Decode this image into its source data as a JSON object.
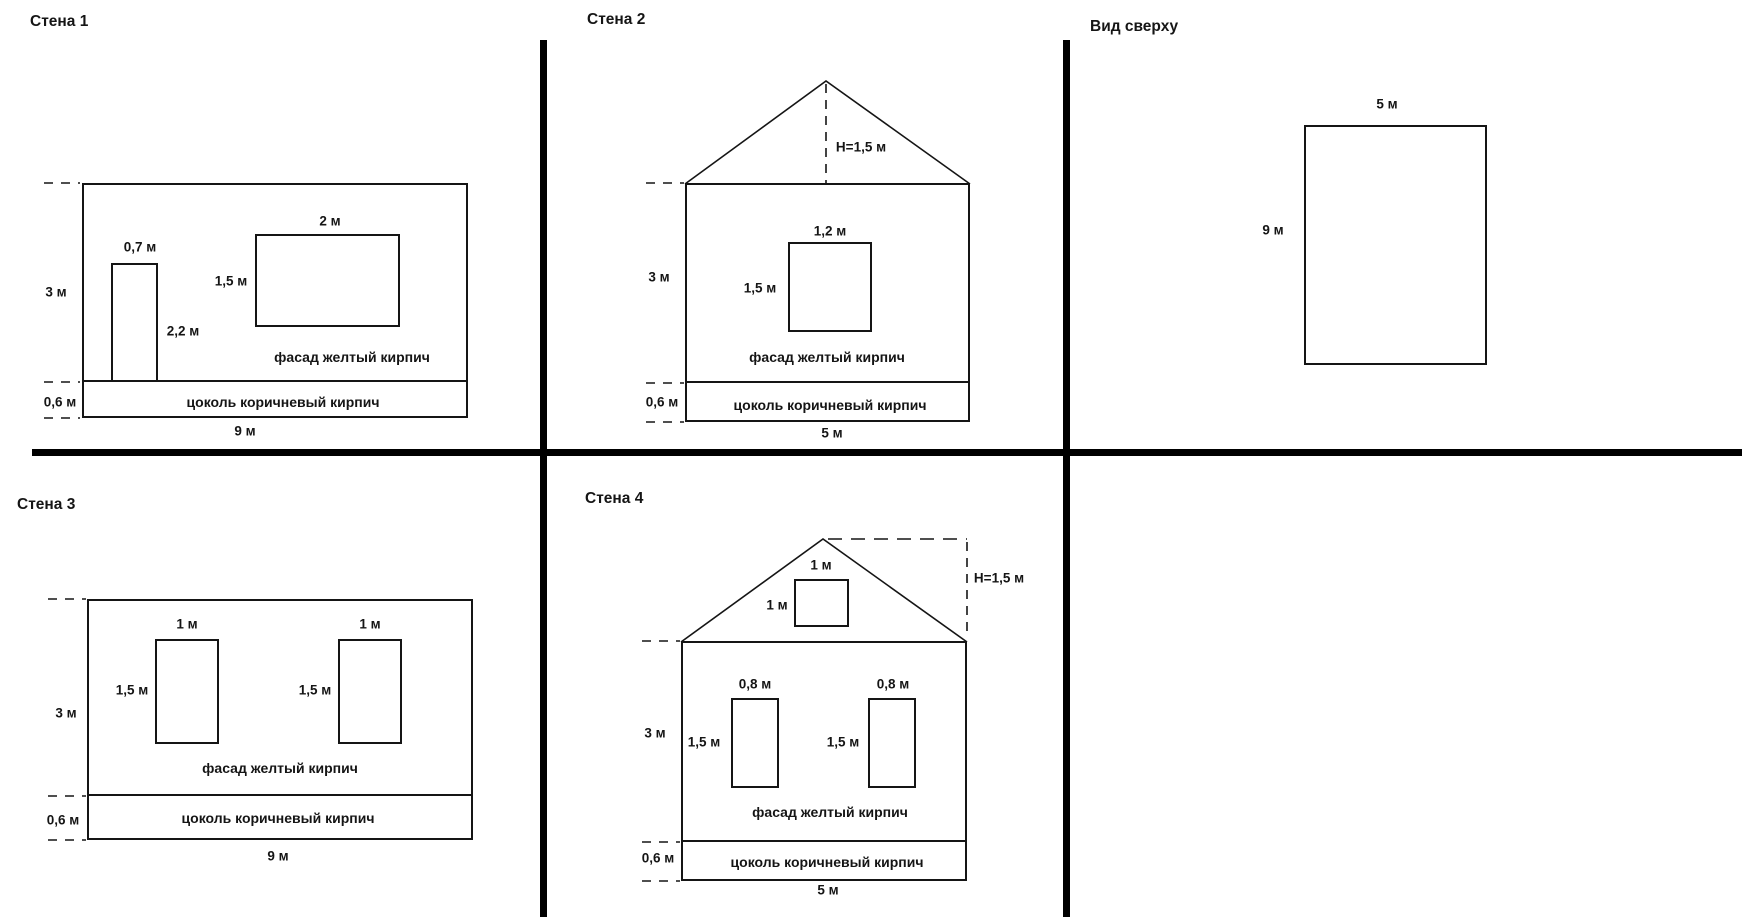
{
  "page": {
    "background": "#ffffff",
    "line_color": "#151515",
    "divider_color": "#000000"
  },
  "sections": {
    "wall1": {
      "title": "Стена 1",
      "labels": {
        "door_width": "0,7 м",
        "door_height": "2,2 м",
        "window_width": "2 м",
        "window_height": "1,5 м",
        "wall_height": "3 м",
        "plinth_height": "0,6 м",
        "wall_width": "9 м",
        "facade_caption": "фасад желтый кирпич",
        "plinth_caption": "цоколь коричневый кирпич"
      }
    },
    "wall2": {
      "title": "Стена 2",
      "labels": {
        "roof_height": "Н=1,5 м",
        "window_width": "1,2 м",
        "window_height": "1,5 м",
        "wall_height": "3 м",
        "plinth_height": "0,6 м",
        "wall_width": "5 м",
        "facade_caption": "фасад желтый кирпич",
        "plinth_caption": "цоколь коричневый кирпич"
      }
    },
    "top_view": {
      "title": "Вид сверху",
      "labels": {
        "width": "5 м",
        "depth": "9 м"
      }
    },
    "wall3": {
      "title": "Стена 3",
      "labels": {
        "window1_width": "1 м",
        "window2_width": "1 м",
        "window1_height": "1,5 м",
        "window2_height": "1,5 м",
        "wall_height": "3 м",
        "plinth_height": "0,6 м",
        "wall_width": "9 м",
        "facade_caption": "фасад желтый кирпич",
        "plinth_caption": "цоколь коричневый кирпич"
      }
    },
    "wall4": {
      "title": "Стена 4",
      "labels": {
        "roof_height": "Н=1,5 м",
        "gable_window_width": "1 м",
        "gable_window_height": "1 м",
        "window1_width": "0,8 м",
        "window2_width": "0,8 м",
        "window1_height": "1,5 м",
        "window2_height": "1,5 м",
        "wall_height": "3 м",
        "plinth_height": "0,6 м",
        "wall_width": "5 м",
        "facade_caption": "фасад желтый кирпич",
        "plinth_caption": "цоколь коричневый кирпич"
      }
    }
  }
}
